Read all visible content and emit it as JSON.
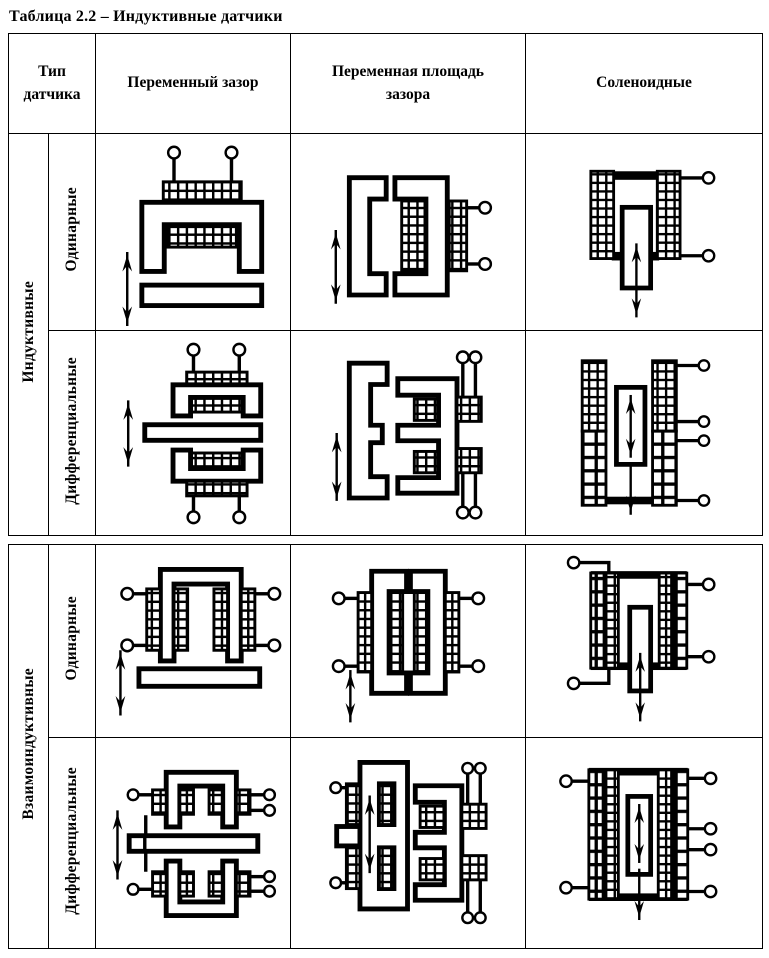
{
  "title": "Таблица 2.2 – Индуктивные датчики",
  "table": {
    "header": {
      "type_col": "Тип датчика",
      "variable_gap_col": "Переменный зазор",
      "variable_area_col": "Переменная площадь зазора",
      "solenoid_col": "Соленоидные"
    },
    "groups": [
      {
        "label": "Индуктивные",
        "subtypes": [
          "Одинарные",
          "Дифференциальные"
        ]
      },
      {
        "label": "Взаимоиндуктивные",
        "subtypes": [
          "Одинарные",
          "Дифференциальные"
        ]
      }
    ]
  }
}
